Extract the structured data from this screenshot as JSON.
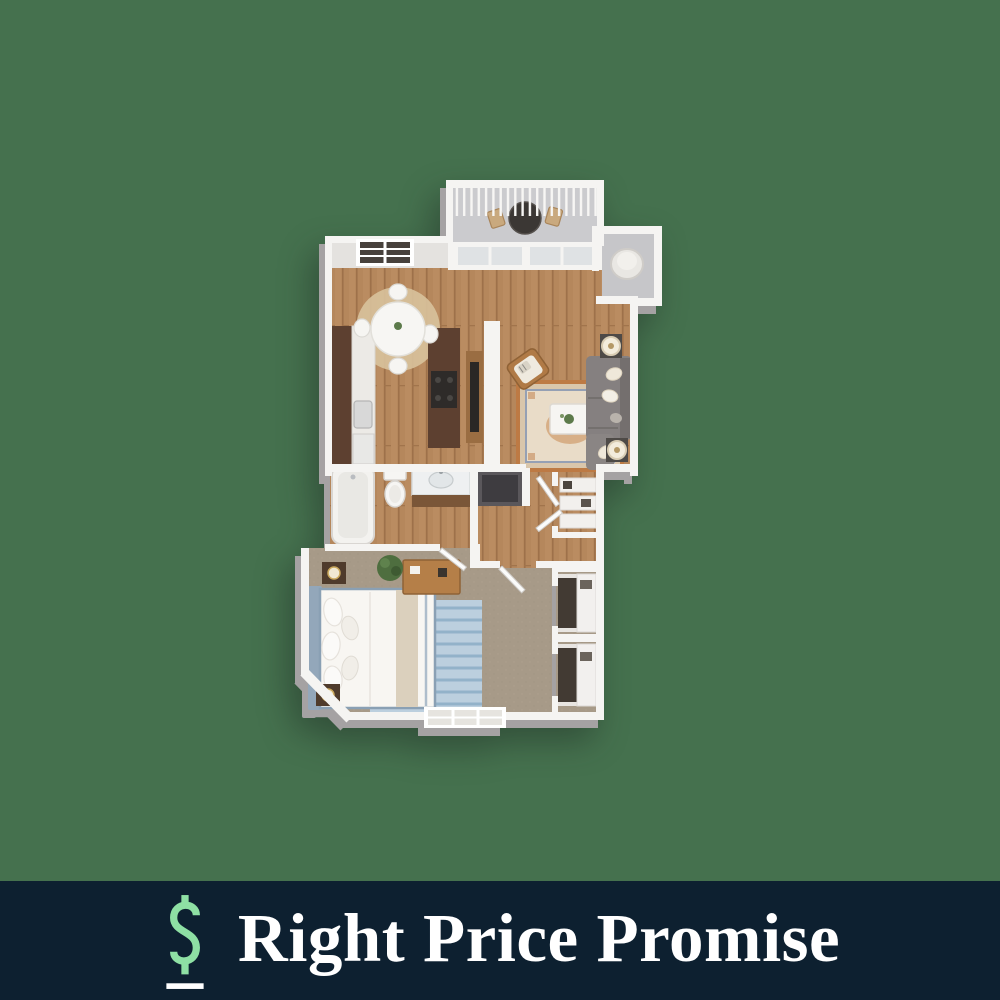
{
  "canvas": {
    "background_color": "#45714e"
  },
  "banner": {
    "text": "Right Price Promise",
    "text_color": "#ffffff",
    "background_color": "#0d2030",
    "icon": {
      "name": "dollar-sign-icon",
      "style": "outlined",
      "color": "#8ee0a4",
      "underline_color": "#ffffff"
    }
  },
  "floor_plan": {
    "kind": "3d-rendered-apartment-floor-plan",
    "layout": "one-bedroom-one-bath",
    "rooms": [
      {
        "name": "balcony",
        "floor": "concrete",
        "features": [
          "railing-with-balusters",
          "bistro-table",
          "two-patio-chairs",
          "sliding-glass-door"
        ]
      },
      {
        "name": "utility-closet",
        "floor": "concrete",
        "features": [
          "water-heater"
        ]
      },
      {
        "name": "kitchen",
        "floor": "hardwood",
        "features": [
          "dark-wood-cabinets",
          "counter-with-sink",
          "island-with-cooktop",
          "appliance"
        ]
      },
      {
        "name": "dining-area",
        "floor": "hardwood",
        "features": [
          "round-white-table",
          "four-white-chairs",
          "round-jute-rug"
        ]
      },
      {
        "name": "living-room",
        "floor": "hardwood",
        "features": [
          "gray-sectional-sofa",
          "throw-pillows",
          "oriental-area-rug",
          "white-coffee-table-with-plant",
          "wood-armchair",
          "two-side-tables-with-drum-lamps",
          "tv-and-media-console",
          "window"
        ]
      },
      {
        "name": "bathroom",
        "floor": "hardwood",
        "features": [
          "bathtub",
          "toilet",
          "vanity-with-sink"
        ]
      },
      {
        "name": "laundry-closet",
        "floor": "concrete",
        "features": []
      },
      {
        "name": "hallway",
        "floor": "hardwood",
        "features": [
          "entry-doors",
          "linen-closet-shelves"
        ]
      },
      {
        "name": "bedroom",
        "floor": "carpet",
        "features": [
          "bed-with-blue-trim",
          "pillows",
          "blue-striped-rug",
          "two-nightstands-with-lamps",
          "wood-dresser",
          "potted-plant",
          "wall-art",
          "window"
        ]
      },
      {
        "name": "bedroom-closets",
        "floor": "carpet",
        "features": [
          "shelving",
          "hanging-clothes"
        ]
      }
    ],
    "palette": {
      "walls": "#f5f4f2",
      "wall_face": "#e4e2df",
      "hardwood": "#b5875c",
      "carpet": "#a79a88",
      "concrete": "#cbcbce",
      "cabinet_wood": "#5d4030",
      "furniture_wood": "#b57f48",
      "sofa_gray": "#858080",
      "rug_accent_orange": "#bd7a44",
      "rug_accent_blue": "#93b2c9"
    }
  }
}
